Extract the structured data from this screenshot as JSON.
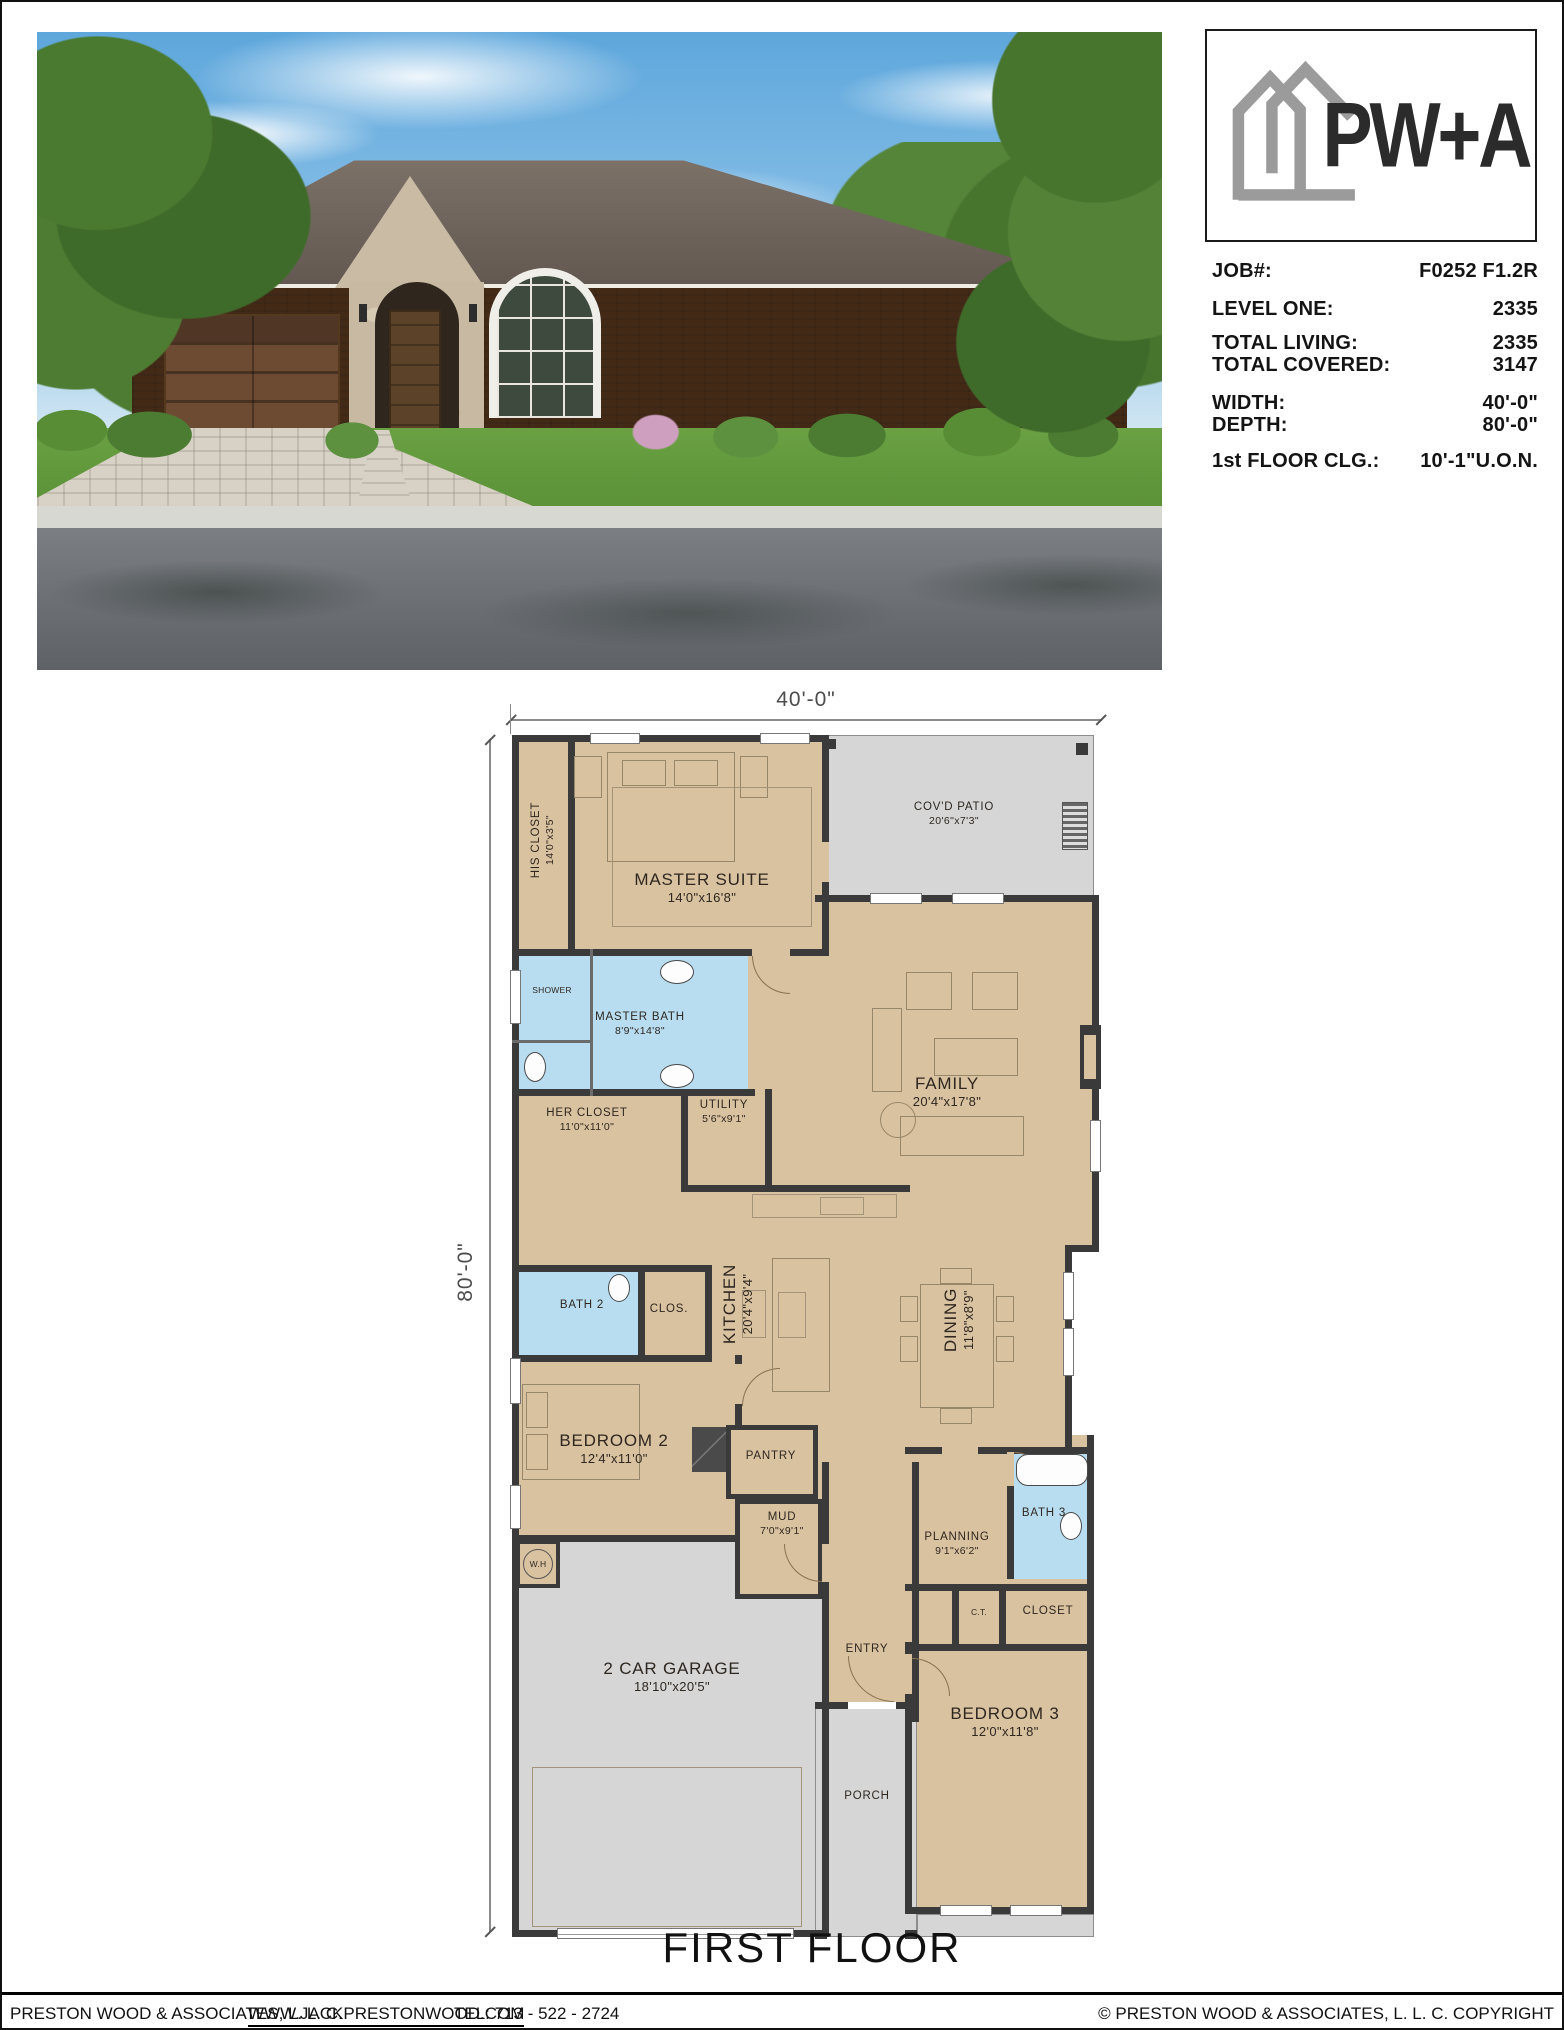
{
  "title_block": {
    "logo_text": "PW+A",
    "rows": [
      {
        "label": "JOB#:",
        "value": "F0252 F1.2R"
      },
      {
        "label": "LEVEL ONE:",
        "value": "2335"
      },
      {
        "label": "TOTAL LIVING:",
        "value": "2335"
      },
      {
        "label": "TOTAL COVERED:",
        "value": "3147"
      },
      {
        "label": "WIDTH:",
        "value": "40'-0\""
      },
      {
        "label": "DEPTH:",
        "value": "80'-0\""
      },
      {
        "label": "1st FLOOR CLG.:",
        "value": "10'-1\"U.O.N."
      }
    ]
  },
  "plan": {
    "width_dim": "40'-0\"",
    "depth_dim": "80'-0\"",
    "title": "FIRST FLOOR"
  },
  "rooms": {
    "his_closet": {
      "name": "HIS CLOSET",
      "dims": "14'0\"x3'5\""
    },
    "master_suite": {
      "name": "MASTER SUITE",
      "dims": "14'0\"x16'8\""
    },
    "covd_patio": {
      "name": "COV'D PATIO",
      "dims": "20'6\"x7'3\""
    },
    "shower": {
      "name": "SHOWER"
    },
    "master_bath": {
      "name": "MASTER BATH",
      "dims": "8'9\"x14'8\""
    },
    "her_closet": {
      "name": "HER CLOSET",
      "dims": "11'0\"x11'0\""
    },
    "utility": {
      "name": "UTILITY",
      "dims": "5'6\"x9'1\""
    },
    "family": {
      "name": "FAMILY",
      "dims": "20'4\"x17'8\""
    },
    "bath_2": {
      "name": "BATH 2"
    },
    "clos": {
      "name": "CLOS."
    },
    "kitchen": {
      "name": "KITCHEN",
      "dims": "20'4\"x9'4\""
    },
    "dining": {
      "name": "DINING",
      "dims": "11'8\"x8'9\""
    },
    "bedroom_2": {
      "name": "BEDROOM 2",
      "dims": "12'4\"x11'0\""
    },
    "pantry": {
      "name": "PANTRY"
    },
    "mud": {
      "name": "MUD",
      "dims": "7'0\"x9'1\""
    },
    "water_heater": {
      "name": "W.H"
    },
    "entry": {
      "name": "ENTRY"
    },
    "planning": {
      "name": "PLANNING",
      "dims": "9'1\"x6'2\""
    },
    "bath_3": {
      "name": "BATH 3"
    },
    "ct": {
      "name": "C.T."
    },
    "closet": {
      "name": "CLOSET"
    },
    "bedroom_3": {
      "name": "BEDROOM 3",
      "dims": "12'0\"x11'8\""
    },
    "porch": {
      "name": "PORCH"
    },
    "garage": {
      "name": "2 CAR GARAGE",
      "dims": "18'10\"x20'5\""
    }
  },
  "footer": {
    "company": "PRESTON WOOD & ASSOCIATES, L. L. C.",
    "website": "WWW.JACKPRESTONWOOD.COM",
    "tel": "TEL:  713 - 522 - 2724",
    "copyright": "© PRESTON WOOD & ASSOCIATES, L. L. C.  COPYRIGHT"
  },
  "colors": {
    "room_tan": "#d9c2a0",
    "bath_blue": "#b9ddf0",
    "slab_gray": "#d6d6d6",
    "wall_dark": "#3a3a3a"
  }
}
